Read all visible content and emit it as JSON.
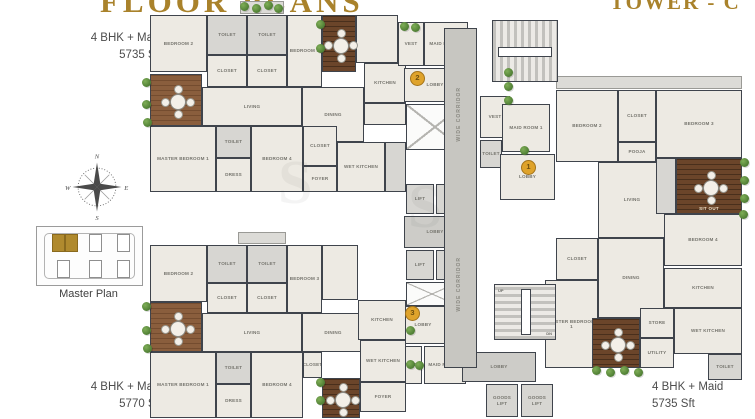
{
  "meta": {
    "title_left": "FLOOR PLANS",
    "title_right": "TOWER - C"
  },
  "labels": {
    "unit_top_left": {
      "line1": "4 BHK + Maid",
      "line2": "5735 Sft"
    },
    "unit_bottom_left": {
      "line1": "4 BHK + Maid",
      "line2": "5770 Sft"
    },
    "unit_bottom_right": {
      "line1": "4 BHK + Maid",
      "line2": "5735 Sft"
    },
    "master_plan_caption": "Master Plan"
  },
  "compass": {
    "n": "N",
    "s": "S",
    "e": "E",
    "w": "W"
  },
  "colors": {
    "title_gold": "#a9822b",
    "wall": "#3f444c",
    "room_fill": "#edeae3",
    "deck_brown": "#8a5e3d",
    "marker_gold": "#dfa32b",
    "plant_green": "#4d7c33"
  },
  "plan": {
    "corridor_label": "WIDE CORRIDOR",
    "watermark": "S",
    "stair_up": "UP",
    "stair_dn": "DN",
    "corridor": {
      "x": 444,
      "y": 28,
      "w": 33,
      "h": 340
    },
    "markers": [
      {
        "n": "1",
        "x": 528,
        "y": 167
      },
      {
        "n": "2",
        "x": 417,
        "y": 78
      },
      {
        "n": "3",
        "x": 412,
        "y": 313
      }
    ],
    "watermark_spots": [
      {
        "x": 278,
        "y": 148
      },
      {
        "x": 408,
        "y": 172
      }
    ],
    "rooms": [
      {
        "l": "BEDROOM 2",
        "x": 150,
        "y": 15,
        "w": 57,
        "h": 57
      },
      {
        "l": "TOILET",
        "x": 207,
        "y": 15,
        "w": 40,
        "h": 40,
        "f": "tile"
      },
      {
        "l": "CLOSET",
        "x": 207,
        "y": 55,
        "w": 40,
        "h": 32
      },
      {
        "l": "TOILET",
        "x": 247,
        "y": 15,
        "w": 40,
        "h": 40,
        "f": "tile"
      },
      {
        "l": "CLOSET",
        "x": 247,
        "y": 55,
        "w": 40,
        "h": 32
      },
      {
        "l": "BEDROOM 3",
        "x": 287,
        "y": 15,
        "w": 35,
        "h": 72
      },
      {
        "l": "",
        "x": 356,
        "y": 15,
        "w": 42,
        "h": 48
      },
      {
        "l": "LIVING",
        "x": 202,
        "y": 87,
        "w": 100,
        "h": 39
      },
      {
        "l": "DINING",
        "x": 302,
        "y": 87,
        "w": 62,
        "h": 55
      },
      {
        "l": "KITCHEN",
        "x": 364,
        "y": 63,
        "w": 42,
        "h": 40
      },
      {
        "l": "",
        "x": 364,
        "y": 103,
        "w": 42,
        "h": 22
      },
      {
        "l": "MASTER BEDROOM 1",
        "x": 150,
        "y": 126,
        "w": 66,
        "h": 66
      },
      {
        "l": "TOILET",
        "x": 216,
        "y": 126,
        "w": 35,
        "h": 32,
        "f": "tile"
      },
      {
        "l": "DRESS",
        "x": 216,
        "y": 158,
        "w": 35,
        "h": 34
      },
      {
        "l": "BEDROOM 4",
        "x": 251,
        "y": 126,
        "w": 52,
        "h": 66
      },
      {
        "l": "CLOSET",
        "x": 303,
        "y": 126,
        "w": 34,
        "h": 40
      },
      {
        "l": "FOYER",
        "x": 303,
        "y": 166,
        "w": 34,
        "h": 26
      },
      {
        "l": "WET KITCHEN",
        "x": 337,
        "y": 142,
        "w": 48,
        "h": 50
      },
      {
        "l": "",
        "x": 385,
        "y": 142,
        "w": 21,
        "h": 50,
        "f": "tile"
      },
      {
        "l": "VEST",
        "x": 398,
        "y": 22,
        "w": 26,
        "h": 44
      },
      {
        "l": "MAID ROOM 2",
        "x": 424,
        "y": 22,
        "w": 44,
        "h": 44
      },
      {
        "l": "LOBBY",
        "x": 404,
        "y": 68,
        "w": 62,
        "h": 34
      },
      {
        "l": "LIFT",
        "x": 406,
        "y": 184,
        "w": 28,
        "h": 30,
        "f": "tile"
      },
      {
        "l": "LIFT",
        "x": 436,
        "y": 184,
        "w": 28,
        "h": 30,
        "f": "tile"
      },
      {
        "l": "LOBBY",
        "x": 404,
        "y": 216,
        "w": 62,
        "h": 32,
        "f": "gray"
      },
      {
        "l": "LIFT",
        "x": 406,
        "y": 250,
        "w": 28,
        "h": 30,
        "f": "tile"
      },
      {
        "l": "LIFT",
        "x": 436,
        "y": 250,
        "w": 28,
        "h": 30,
        "f": "tile"
      },
      {
        "l": "LOBBY",
        "x": 398,
        "y": 306,
        "w": 50,
        "h": 38
      },
      {
        "l": "VEST",
        "x": 398,
        "y": 346,
        "w": 24,
        "h": 38
      },
      {
        "l": "MAID ROOM 3",
        "x": 424,
        "y": 346,
        "w": 42,
        "h": 38
      },
      {
        "l": "VEST",
        "x": 480,
        "y": 96,
        "w": 30,
        "h": 42
      },
      {
        "l": "LOBBY",
        "x": 462,
        "y": 352,
        "w": 74,
        "h": 30,
        "f": "gray"
      },
      {
        "l": "GOODS LIFT",
        "x": 486,
        "y": 384,
        "w": 32,
        "h": 33,
        "f": "tile"
      },
      {
        "l": "GOODS LIFT",
        "x": 521,
        "y": 384,
        "w": 32,
        "h": 33,
        "f": "tile"
      },
      {
        "l": "MAID ROOM 1",
        "x": 502,
        "y": 104,
        "w": 48,
        "h": 48
      },
      {
        "l": "TOILET",
        "x": 480,
        "y": 140,
        "w": 22,
        "h": 28,
        "f": "tile"
      },
      {
        "l": "LOBBY",
        "x": 500,
        "y": 154,
        "w": 55,
        "h": 46
      },
      {
        "l": "BEDROOM 2",
        "x": 556,
        "y": 90,
        "w": 62,
        "h": 72
      },
      {
        "l": "CLOSET",
        "x": 618,
        "y": 90,
        "w": 38,
        "h": 52
      },
      {
        "l": "POOJA",
        "x": 618,
        "y": 142,
        "w": 38,
        "h": 20
      },
      {
        "l": "BEDROOM 3",
        "x": 656,
        "y": 90,
        "w": 86,
        "h": 68
      },
      {
        "l": "LIVING",
        "x": 598,
        "y": 162,
        "w": 68,
        "h": 76
      },
      {
        "l": "",
        "x": 656,
        "y": 158,
        "w": 20,
        "h": 56,
        "f": "tile"
      },
      {
        "l": "BEDROOM 4",
        "x": 664,
        "y": 214,
        "w": 78,
        "h": 52
      },
      {
        "l": "CLOSET",
        "x": 556,
        "y": 238,
        "w": 42,
        "h": 42
      },
      {
        "l": "DINING",
        "x": 598,
        "y": 238,
        "w": 66,
        "h": 80
      },
      {
        "l": "KITCHEN",
        "x": 664,
        "y": 268,
        "w": 78,
        "h": 40
      },
      {
        "l": "MASTER BEDROOM 1",
        "x": 545,
        "y": 280,
        "w": 53,
        "h": 88
      },
      {
        "l": "STORE",
        "x": 640,
        "y": 308,
        "w": 34,
        "h": 30
      },
      {
        "l": "WET KITCHEN",
        "x": 674,
        "y": 308,
        "w": 68,
        "h": 46
      },
      {
        "l": "UTILITY",
        "x": 640,
        "y": 338,
        "w": 34,
        "h": 30
      },
      {
        "l": "TOILET",
        "x": 708,
        "y": 354,
        "w": 34,
        "h": 26,
        "f": "tile"
      },
      {
        "l": "BEDROOM 2",
        "x": 150,
        "y": 245,
        "w": 57,
        "h": 57
      },
      {
        "l": "TOILET",
        "x": 207,
        "y": 245,
        "w": 40,
        "h": 38,
        "f": "tile"
      },
      {
        "l": "CLOSET",
        "x": 207,
        "y": 283,
        "w": 40,
        "h": 30
      },
      {
        "l": "TOILET",
        "x": 247,
        "y": 245,
        "w": 40,
        "h": 38,
        "f": "tile"
      },
      {
        "l": "CLOSET",
        "x": 247,
        "y": 283,
        "w": 40,
        "h": 30
      },
      {
        "l": "BEDROOM 3",
        "x": 287,
        "y": 245,
        "w": 35,
        "h": 68
      },
      {
        "l": "",
        "x": 322,
        "y": 245,
        "w": 36,
        "h": 55
      },
      {
        "l": "LIVING",
        "x": 202,
        "y": 313,
        "w": 100,
        "h": 39
      },
      {
        "l": "DINING",
        "x": 302,
        "y": 313,
        "w": 62,
        "h": 39
      },
      {
        "l": "KITCHEN",
        "x": 358,
        "y": 300,
        "w": 48,
        "h": 40
      },
      {
        "l": "MASTER BEDROOM 1",
        "x": 150,
        "y": 352,
        "w": 66,
        "h": 66
      },
      {
        "l": "TOILET",
        "x": 216,
        "y": 352,
        "w": 35,
        "h": 32,
        "f": "tile"
      },
      {
        "l": "DRESS",
        "x": 216,
        "y": 384,
        "w": 35,
        "h": 34
      },
      {
        "l": "BEDROOM 4",
        "x": 251,
        "y": 352,
        "w": 52,
        "h": 66
      },
      {
        "l": "CLOSET",
        "x": 303,
        "y": 352,
        "w": 19,
        "h": 26
      },
      {
        "l": "WET KITCHEN",
        "x": 360,
        "y": 340,
        "w": 46,
        "h": 42
      },
      {
        "l": "FOYER",
        "x": 360,
        "y": 382,
        "w": 46,
        "h": 30
      }
    ],
    "decks": [
      {
        "x": 150,
        "y": 74,
        "w": 52,
        "h": 52,
        "table": 1
      },
      {
        "x": 322,
        "y": 15,
        "w": 34,
        "h": 57,
        "v": "dark",
        "table": 1
      },
      {
        "x": 150,
        "y": 302,
        "w": 52,
        "h": 50,
        "table": 1
      },
      {
        "x": 322,
        "y": 378,
        "w": 38,
        "h": 40,
        "v": "dark",
        "table": 1
      },
      {
        "x": 676,
        "y": 158,
        "w": 66,
        "h": 56,
        "v": "dark",
        "table": 1,
        "l": "SIT OUT"
      },
      {
        "x": 592,
        "y": 318,
        "w": 48,
        "h": 50,
        "v": "dark",
        "table": 1
      }
    ],
    "shafts": [
      {
        "x": 406,
        "y": 104,
        "w": 58,
        "h": 46
      },
      {
        "x": 406,
        "y": 282,
        "w": 52,
        "h": 24
      }
    ],
    "stairs": [
      {
        "x": 492,
        "y": 20,
        "w": 66,
        "h": 62,
        "dir": "v"
      },
      {
        "x": 494,
        "y": 284,
        "w": 62,
        "h": 56,
        "dir": "h",
        "up": true
      }
    ],
    "ledges": [
      {
        "x": 240,
        "y": 1,
        "w": 44,
        "h": 13
      },
      {
        "x": 238,
        "y": 232,
        "w": 48,
        "h": 12
      },
      {
        "x": 556,
        "y": 76,
        "w": 186,
        "h": 13
      }
    ],
    "plants": [
      [
        146,
        82
      ],
      [
        146,
        104
      ],
      [
        147,
        122
      ],
      [
        244,
        6
      ],
      [
        256,
        8
      ],
      [
        268,
        5
      ],
      [
        278,
        8
      ],
      [
        320,
        24
      ],
      [
        320,
        48
      ],
      [
        404,
        26
      ],
      [
        415,
        27
      ],
      [
        508,
        72
      ],
      [
        508,
        86
      ],
      [
        508,
        100
      ],
      [
        524,
        150
      ],
      [
        744,
        162
      ],
      [
        744,
        180
      ],
      [
        744,
        198
      ],
      [
        743,
        214
      ],
      [
        146,
        306
      ],
      [
        146,
        330
      ],
      [
        147,
        348
      ],
      [
        596,
        370
      ],
      [
        610,
        372
      ],
      [
        624,
        370
      ],
      [
        638,
        372
      ],
      [
        320,
        382
      ],
      [
        320,
        400
      ],
      [
        410,
        330
      ],
      [
        410,
        364
      ],
      [
        419,
        365
      ]
    ]
  }
}
